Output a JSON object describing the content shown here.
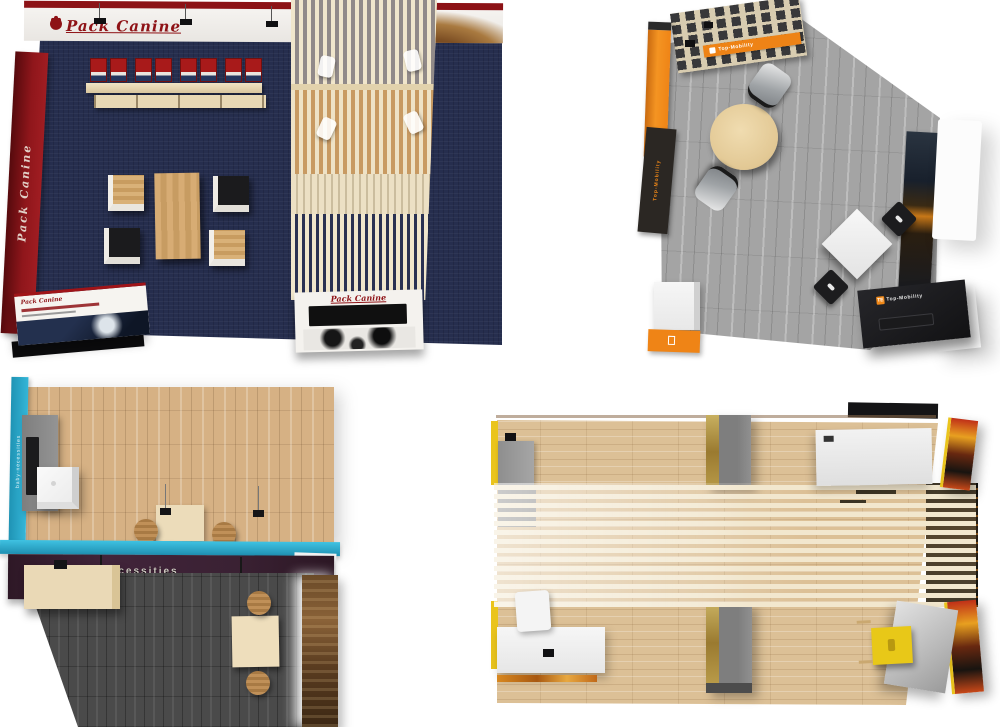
{
  "scene": {
    "description": "Four top-down 3D renders of exhibition booth designs on a white background",
    "background_color": "#ffffff"
  },
  "booths": {
    "pack_canine": {
      "position": "top-left",
      "logo_text": "Pack Canine",
      "side_wall_text": "Pack Canine",
      "display_panel_text": "Pack Canine",
      "counter_text": "Pack Canine",
      "colors": {
        "wall_red": "#8e1216",
        "carpet_navy": "#262e4e",
        "wood_slat": "#ecdfc2",
        "product_red": "#a81a1a"
      }
    },
    "top_mobility": {
      "position": "top-right",
      "shelf_banner_text": "Top-Mobility",
      "counter_logo_icon": "TE",
      "counter_logo_text": "Top-Mobility",
      "side_sign_text": "Top-Mobility",
      "colors": {
        "accent_orange": "#ee8316",
        "floor_gray": "#a4a4a4",
        "counter_black": "#1a1a1c"
      }
    },
    "baby_necessities": {
      "position": "bottom-left",
      "banner_text": "baby-necessities",
      "side_text": "baby-necessities",
      "colors": {
        "accent_teal": "#2fb0d2",
        "banner_plum": "#3a2133",
        "floor_wood_light": "#d6b184",
        "floor_wood_dark": "#4a4a4a"
      }
    },
    "slat_pavilion": {
      "position": "bottom-right",
      "colors": {
        "accent_yellow": "#eac41c",
        "floor_wood": "#dcc096",
        "divider_gray": "#8e8e8e",
        "canopy_slat": "#f2e7ce"
      }
    }
  }
}
